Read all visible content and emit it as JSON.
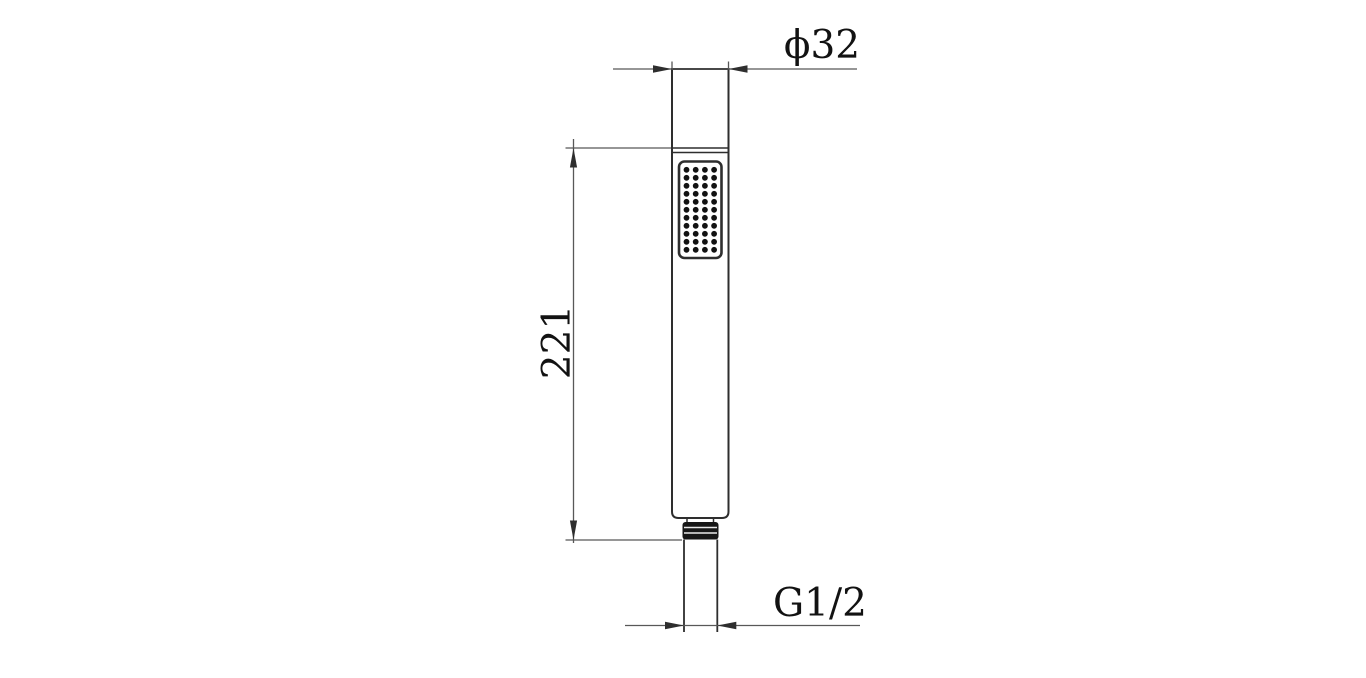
{
  "page": {
    "background": "#ffffff",
    "description": "Technical dimension drawing of a handheld shower wand"
  },
  "labels": {
    "diameter": "ϕ32",
    "length": "221",
    "thread": "G1/2"
  },
  "dimensions": [
    {
      "name": "head-outer-diameter",
      "label": "ϕ32"
    },
    {
      "name": "body-length",
      "label": "221"
    },
    {
      "name": "inlet-thread-size",
      "label": "G1/2"
    }
  ],
  "colors": {
    "object_line": "#2e2e2e",
    "dimension_line": "#585858",
    "text": "#121212",
    "thread_fill": "#161616",
    "background": "#ffffff"
  },
  "spray_face": {
    "dot_rows": 11,
    "dot_cols": 4
  }
}
